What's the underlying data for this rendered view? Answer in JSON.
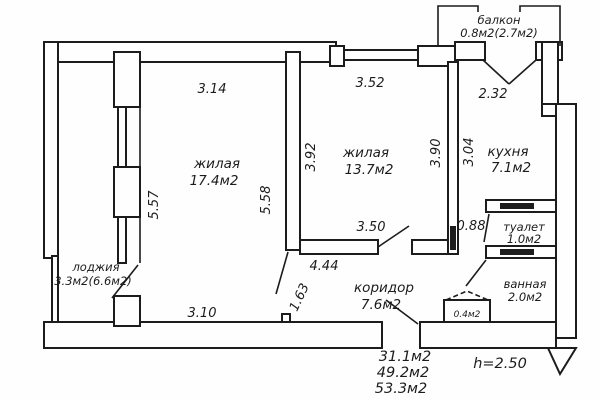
{
  "colors": {
    "ink": "#1c1c1c",
    "paper": "#fefefe"
  },
  "rooms": {
    "balcony": {
      "name": "балкон",
      "area": "0.8м2(2.7м2)"
    },
    "living1": {
      "name": "жилая",
      "area": "17.4м2"
    },
    "living2": {
      "name": "жилая",
      "area": "13.7м2"
    },
    "kitchen": {
      "name": "кухня",
      "area": "7.1м2"
    },
    "toilet": {
      "name": "туалет",
      "area": "1.0м2"
    },
    "bath": {
      "name": "ванная",
      "area": "2.0м2"
    },
    "corridor": {
      "name": "коридор",
      "area": "7.6м2"
    },
    "loggia": {
      "name": "лоджия",
      "area": "3.3м2(6.6м2)"
    },
    "closet": {
      "area": "0.4м2"
    }
  },
  "dimensions": {
    "living1_top": "3.14",
    "living1_left": "5.57",
    "living1_right": "5.58",
    "living1_bottom": "3.10",
    "living2_top": "3.52",
    "living2_left": "3.92",
    "living2_right": "3.90",
    "living2_bottom": "3.50",
    "kitchen_top": "2.32",
    "kitchen_left": "3.04",
    "corridor_length": "4.44",
    "corridor_door": "1.63",
    "passage_width": "0.88"
  },
  "summary": {
    "living_area": "31.1м2",
    "floor_area": "49.2м2",
    "total_area": "53.3м2",
    "ceiling_height": "h=2.50"
  }
}
